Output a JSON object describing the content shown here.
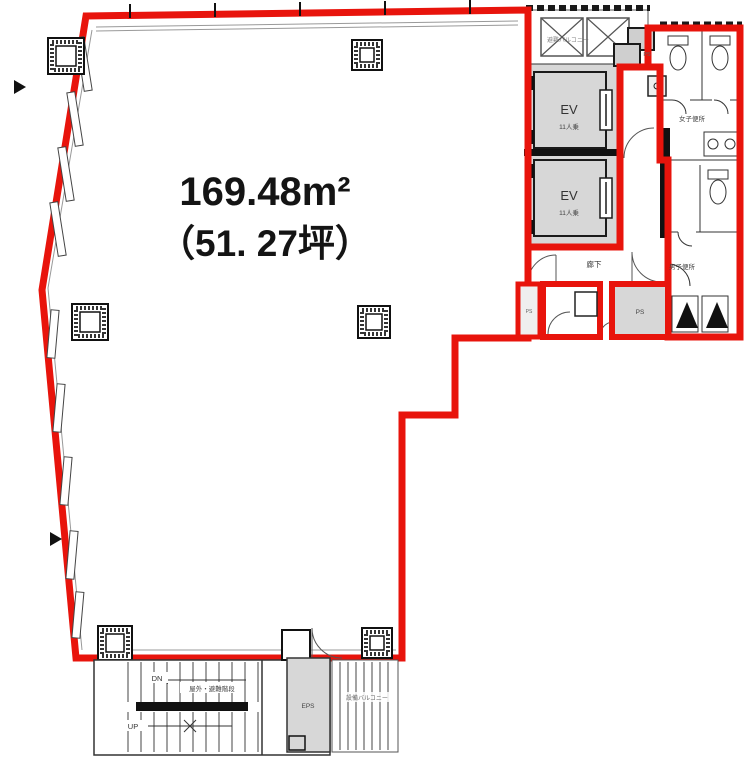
{
  "colors": {
    "outline_red": "#e8140c",
    "shaft_gray": "#d7d7d7",
    "wall_black": "#111111",
    "label_gray": "#555555"
  },
  "floorplan": {
    "area": {
      "m2": "169.48m²",
      "tsubo": "（51. 27坪）"
    },
    "elevators": {
      "label": "EV",
      "capacity": "11人乗"
    },
    "rooms": {
      "corridor": "廊下",
      "womens_toilet": "女子便所",
      "mens_toilet": "男子便所"
    },
    "shafts": {
      "ps": "PS",
      "eps": "EPS"
    },
    "stairs": {
      "up": "UP",
      "down": "DN",
      "name": "屋外・避難階段"
    },
    "balconies": {
      "service": "設備バルコニー",
      "escape": "避難バルコニー"
    }
  }
}
